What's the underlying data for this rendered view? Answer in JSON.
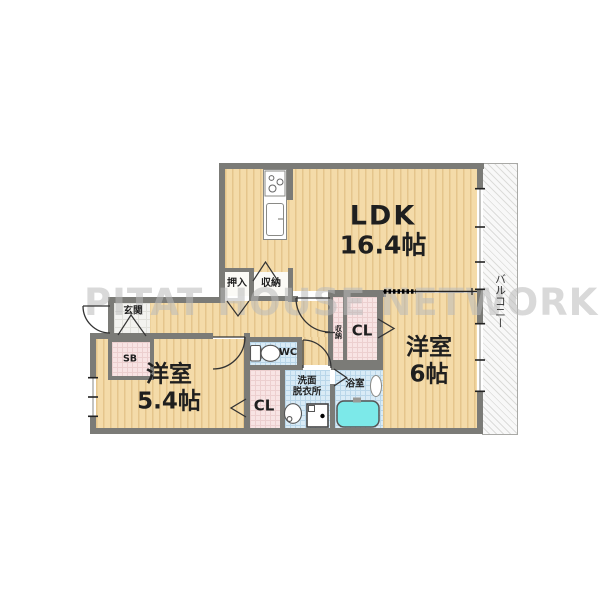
{
  "watermark": "PITAT HOUSE NETWORK",
  "rooms": {
    "ldk": {
      "name": "LDK",
      "size": "16.4帖"
    },
    "western6": {
      "name": "洋室",
      "size": "6帖"
    },
    "western54": {
      "name": "洋室",
      "size": "5.4帖"
    },
    "balcony": {
      "name": "バルコニー"
    },
    "entrance": {
      "name": "玄関"
    },
    "shoe_box": {
      "name": "SB"
    },
    "toilet": {
      "name": "WC"
    },
    "washroom": {
      "line1": "洗面",
      "line2": "脱衣所"
    },
    "bathroom": {
      "name": "浴室"
    },
    "closet_hall": {
      "name": "CL"
    },
    "closet_room54": {
      "name": "CL"
    },
    "oshiire": {
      "name": "押入"
    },
    "storage_ldk": {
      "name": "収納"
    },
    "storage_narrow": {
      "name": "収納"
    }
  },
  "colors": {
    "floor": "#f4dba9",
    "floor_stripe": "#e5c58c",
    "wall": "#7b7b77",
    "closet_fill": "#f8e4e4",
    "wet_area_fill": "#d9ebf6",
    "bathtub": "#7ce9e9",
    "watermark_gray": "#b9b9b9"
  }
}
